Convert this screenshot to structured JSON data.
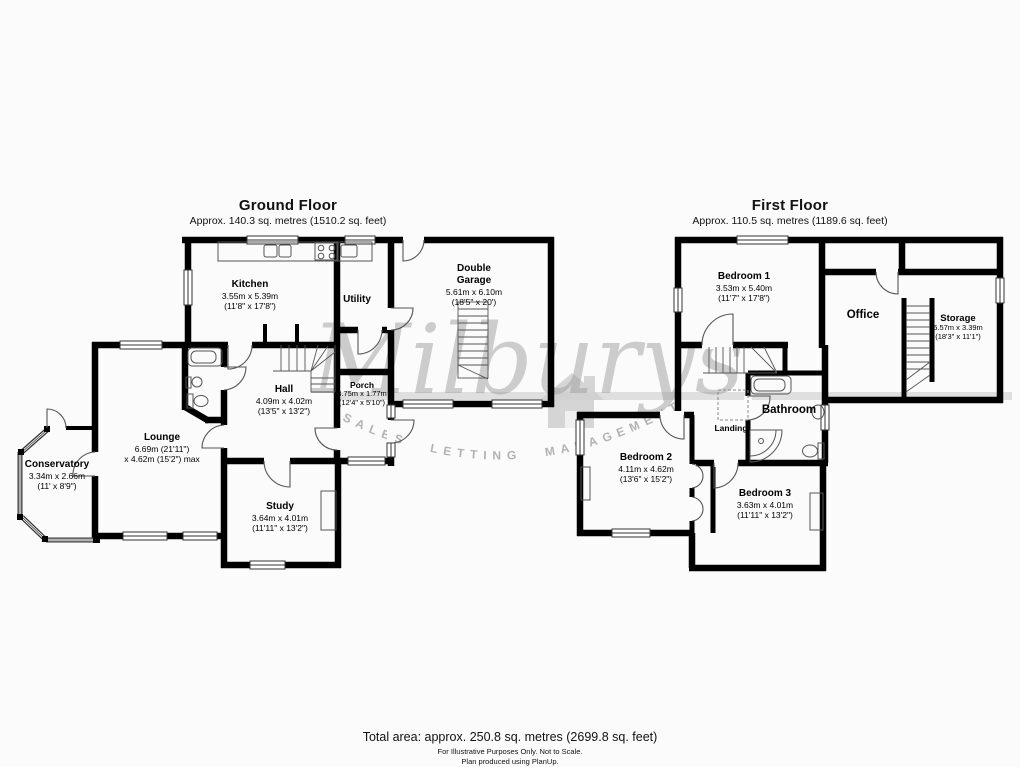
{
  "watermark": {
    "brand": "Milburys",
    "tagline": "SALES LETTING MANAGEMENT",
    "bar_color": "#d8d8d8",
    "text_color": "#b5b5b5"
  },
  "floors": {
    "ground": {
      "title": "Ground Floor",
      "subtitle": "Approx. 140.3 sq. metres (1510.2 sq. feet)",
      "rooms": {
        "kitchen": {
          "name": "Kitchen",
          "metric": "3.55m x 5.39m",
          "imperial": "(11'8\" x 17'8\")"
        },
        "utility": {
          "name": "Utility"
        },
        "garage": {
          "name": "Double Garage",
          "metric": "5.61m x 6.10m",
          "imperial": "(18'5\" x 20')"
        },
        "hall": {
          "name": "Hall",
          "metric": "4.09m x 4.02m",
          "imperial": "(13'5\" x 13'2\")"
        },
        "porch": {
          "name": "Porch",
          "metric": "3.75m x 1.77m",
          "imperial": "(12'4\" x 5'10\")"
        },
        "lounge": {
          "name": "Lounge",
          "metric": "6.69m (21'11\")",
          "imperial": "x 4.62m (15'2\") max"
        },
        "study": {
          "name": "Study",
          "metric": "3.64m x 4.01m",
          "imperial": "(11'11\" x 13'2\")"
        },
        "conservatory": {
          "name": "Conservatory",
          "metric": "3.34m x 2.66m",
          "imperial": "(11' x 8'9\")"
        }
      }
    },
    "first": {
      "title": "First Floor",
      "subtitle": "Approx. 110.5 sq. metres (1189.6 sq. feet)",
      "rooms": {
        "bedroom1": {
          "name": "Bedroom 1",
          "metric": "3.53m x 5.40m",
          "imperial": "(11'7\" x 17'8\")"
        },
        "office": {
          "name": "Office"
        },
        "storage": {
          "name": "Storage",
          "metric": "5.57m x 3.39m",
          "imperial": "(18'3\" x 11'1\")"
        },
        "landing": {
          "name": "Landing"
        },
        "bathroom": {
          "name": "Bathroom"
        },
        "bedroom2": {
          "name": "Bedroom 2",
          "metric": "4.11m x 4.62m",
          "imperial": "(13'6\" x 15'2\")"
        },
        "bedroom3": {
          "name": "Bedroom 3",
          "metric": "3.63m x 4.01m",
          "imperial": "(11'11\" x 13'2\")"
        }
      }
    }
  },
  "footer": {
    "total_area": "Total area: approx. 250.8 sq. metres (2699.8 sq. feet)",
    "disclaimer": "For Illustrative Purposes Only. Not to Scale.",
    "credit": "Plan produced using PlanUp."
  }
}
